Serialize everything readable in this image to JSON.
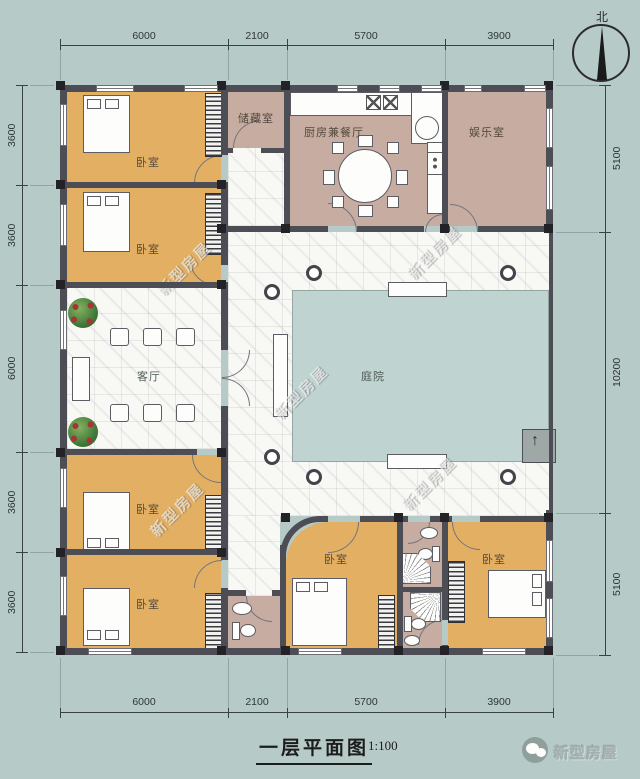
{
  "title_block": {
    "title": "一层平面图",
    "scale": "1:100"
  },
  "compass": {
    "north_label": "北"
  },
  "rooms": {
    "bedroom": "卧室",
    "storage": "储藏室",
    "kitchen_dining": "厨房兼餐厅",
    "entertainment": "娱乐室",
    "living": "客厅",
    "courtyard": "庭院"
  },
  "dimensions": {
    "top": [
      "6000",
      "2100",
      "5700",
      "3900"
    ],
    "bottom": [
      "6000",
      "2100",
      "5700",
      "3900"
    ],
    "left": [
      "3600",
      "3600",
      "6000",
      "3600",
      "3600"
    ],
    "right": [
      "5100",
      "10200",
      "5100"
    ]
  },
  "watermark": "新型房屋",
  "logo": {
    "name": "新型房屋"
  },
  "entry_arrow": "↑",
  "colors": {
    "background": "#b6cac7",
    "bedroom_fill": "#e3b063",
    "service_fill": "#c6aca1",
    "courtyard_fill": "#bfd3d0",
    "wall": "#4d4d55",
    "walkway": "#f8f8f5"
  }
}
